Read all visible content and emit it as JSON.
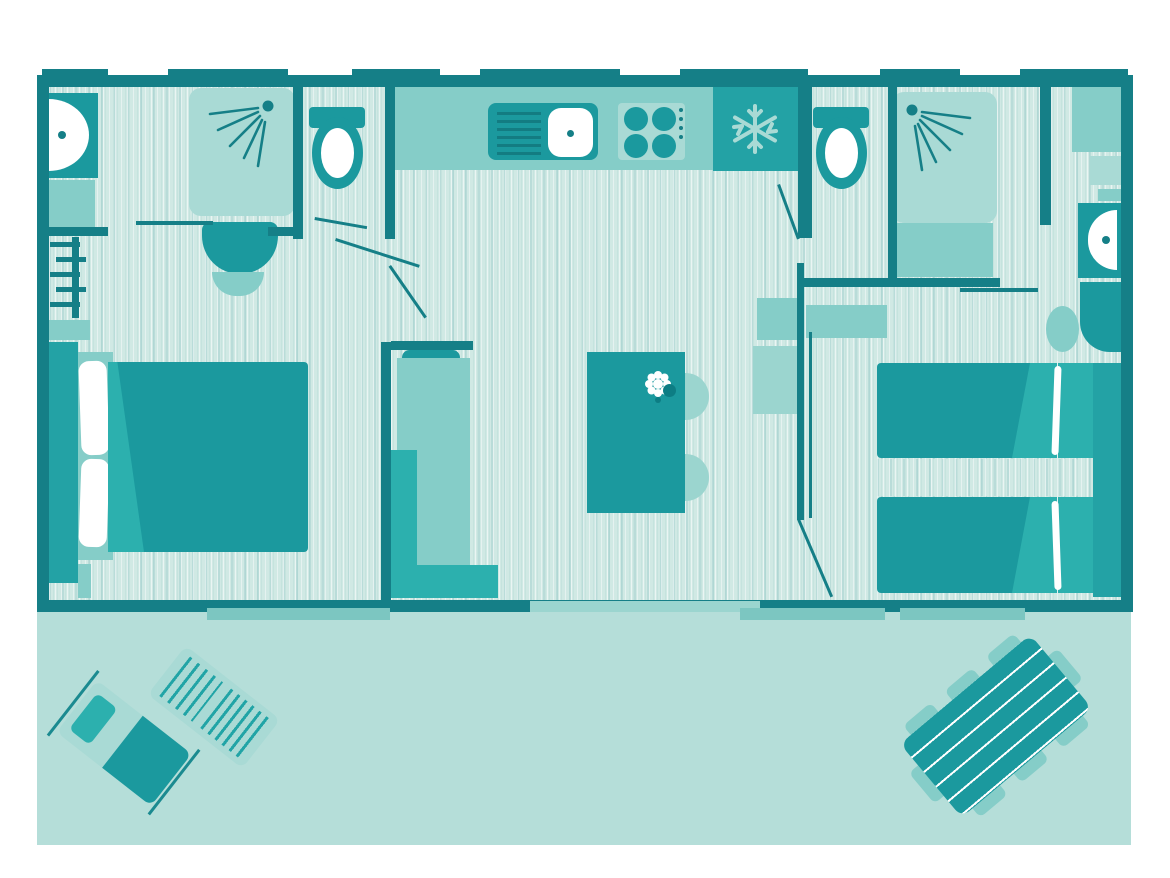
{
  "meta": {
    "type": "floor-plan",
    "description": "Top-down floor plan of a two-bedroom mobile home / holiday lodge with kitchen-living area, two shower rooms, two WCs and a front terrace",
    "orientation": "terrace at bottom"
  },
  "palette": {
    "wall": "#157f87",
    "furniture_teal": "#1b999e",
    "appliance_teal": "#23a2a5",
    "accent_bright": "#2cb0ae",
    "medium_teal": "#85cdc8",
    "soft_teal": "#9bd5cf",
    "light_teal": "#a9dad5",
    "terrace": "#b5ded9",
    "floor": "#d0e9e4",
    "white": "#ffffff"
  },
  "rooms": [
    {
      "name": "bathroom-left",
      "items": [
        "wall-basin",
        "shower-cubicle",
        "pedestal-washbasin",
        "towel-rack",
        "shelf"
      ]
    },
    {
      "name": "wc-left",
      "items": [
        "toilet"
      ]
    },
    {
      "name": "bedroom-double",
      "items": [
        "double-bed",
        "headboard",
        "pillows",
        "duvet",
        "foot-shelf"
      ]
    },
    {
      "name": "kitchen",
      "items": [
        "worktop",
        "sink-with-drainer",
        "hob-4-burners",
        "fridge"
      ]
    },
    {
      "name": "living-dining",
      "items": [
        "corner-sofa",
        "bench",
        "dining-table",
        "two-chairs",
        "flower-decoration",
        "sideboard"
      ]
    },
    {
      "name": "wc-right",
      "items": [
        "toilet"
      ]
    },
    {
      "name": "shower-room-right",
      "items": [
        "shower-cubicle"
      ]
    },
    {
      "name": "bedroom-twin",
      "items": [
        "single-bed-top",
        "single-bed-bottom",
        "wardrobe",
        "wall-basin",
        "vanity-with-stool",
        "shelf"
      ]
    },
    {
      "name": "terrace",
      "items": [
        "sun-lounger-with-towel",
        "sun-lounger-slatted",
        "picnic-table"
      ]
    }
  ],
  "icons": {
    "fridge": "snowflake-icon",
    "shower": "spray-icon",
    "table_decor": "flower-icon"
  }
}
